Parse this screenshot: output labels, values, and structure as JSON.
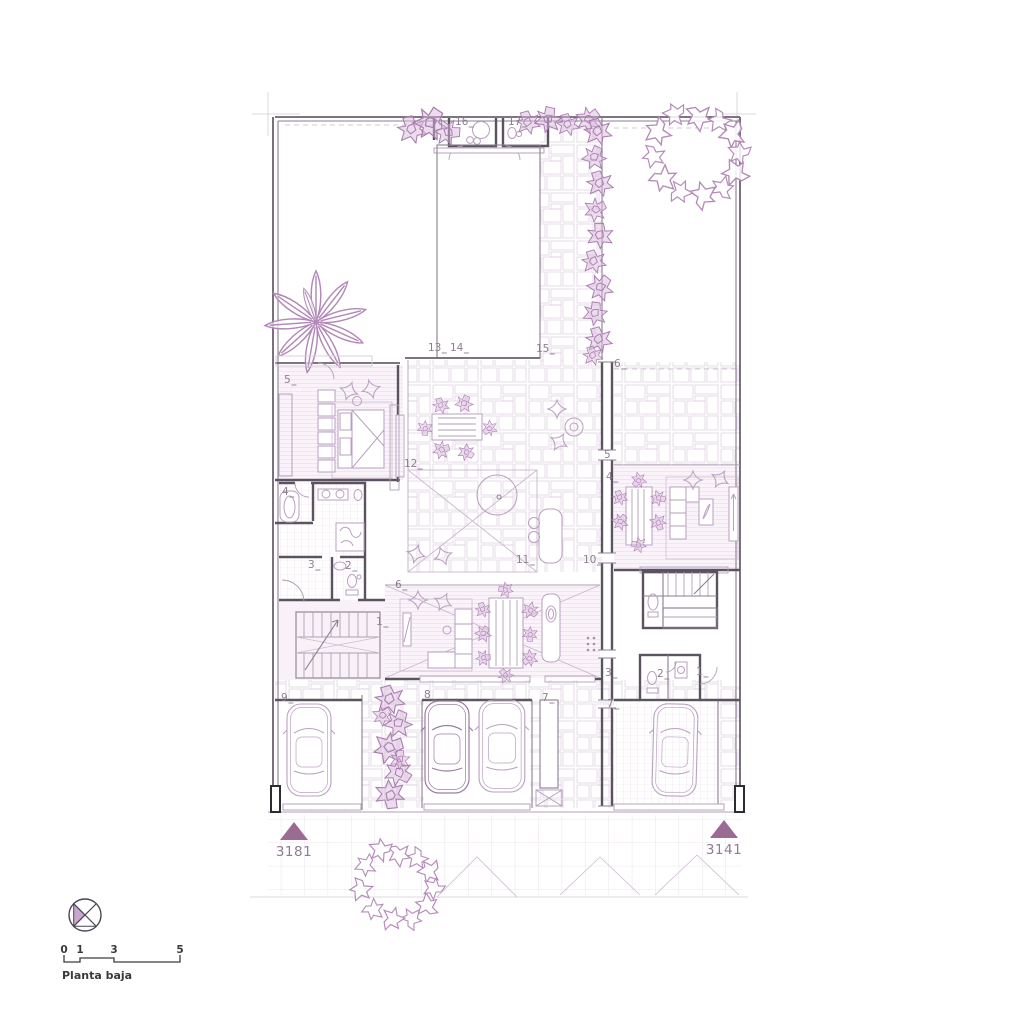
{
  "title": "Planta baja",
  "scale": {
    "t0": "0",
    "t1": "1",
    "t2": "3",
    "t3": "5"
  },
  "markers": {
    "left": "3181",
    "right": "3141"
  },
  "labels": [
    {
      "text": "16",
      "x": 455,
      "y": 125
    },
    {
      "text": "17",
      "x": 508,
      "y": 125
    },
    {
      "text": "13",
      "x": 428,
      "y": 351
    },
    {
      "text": "14",
      "x": 450,
      "y": 351
    },
    {
      "text": "15",
      "x": 536,
      "y": 352
    },
    {
      "text": "6",
      "x": 614,
      "y": 367
    },
    {
      "text": "5",
      "x": 284,
      "y": 383
    },
    {
      "text": "12",
      "x": 404,
      "y": 467
    },
    {
      "text": "4",
      "x": 282,
      "y": 495
    },
    {
      "text": "5",
      "x": 604,
      "y": 458
    },
    {
      "text": "4",
      "x": 606,
      "y": 480
    },
    {
      "text": "3",
      "x": 308,
      "y": 568
    },
    {
      "text": "2",
      "x": 345,
      "y": 569
    },
    {
      "text": "11",
      "x": 516,
      "y": 563
    },
    {
      "text": "10",
      "x": 583,
      "y": 563
    },
    {
      "text": "6",
      "x": 395,
      "y": 588
    },
    {
      "text": "1",
      "x": 376,
      "y": 625
    },
    {
      "text": "3",
      "x": 605,
      "y": 676
    },
    {
      "text": "2",
      "x": 657,
      "y": 677
    },
    {
      "text": "1",
      "x": 696,
      "y": 675
    },
    {
      "text": "9",
      "x": 281,
      "y": 701
    },
    {
      "text": "8",
      "x": 424,
      "y": 698
    },
    {
      "text": "7",
      "x": 542,
      "y": 701
    },
    {
      "text": "7",
      "x": 607,
      "y": 707
    }
  ],
  "colors": {
    "ink": "#8c7d91",
    "wall": "#5b5360",
    "plant": "#a87cae",
    "accent_fill": "#9c6b94",
    "paving_line": "#dccade"
  }
}
